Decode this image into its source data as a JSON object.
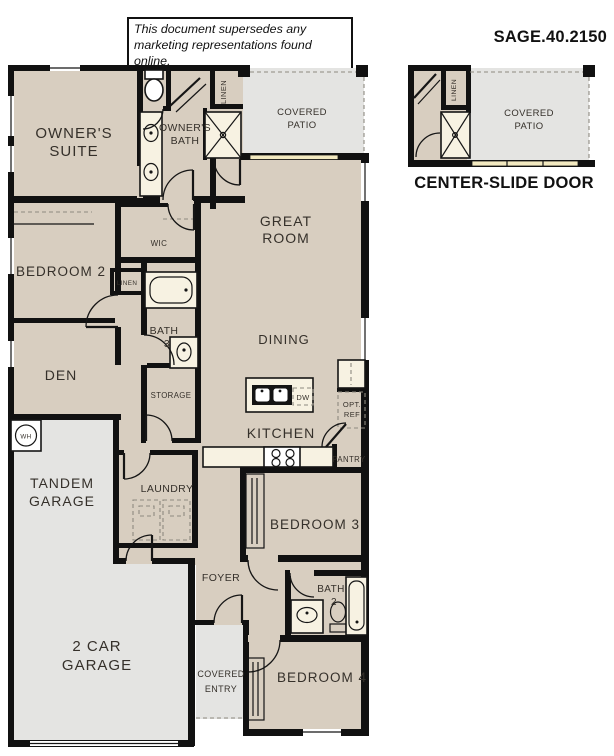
{
  "header": {
    "disclaimer": [
      "This document supersedes any",
      "marketing representations found online."
    ],
    "plan_code": "SAGE.40.2150"
  },
  "labels": {
    "owners_suite": [
      "OWNER'S",
      "SUITE"
    ],
    "owners_bath": [
      "OWNER'S",
      "BATH"
    ],
    "linen": "LINEN",
    "covered_patio": [
      "COVERED",
      "PATIO"
    ],
    "great_room": [
      "GREAT",
      "ROOM"
    ],
    "bedroom2": "BEDROOM 2",
    "wic": "WIC",
    "bath3": [
      "BATH",
      "3"
    ],
    "den": "DEN",
    "storage": "STORAGE",
    "dining": "DINING",
    "kitchen": "KITCHEN",
    "dw": "DW",
    "opt_ref": [
      "OPT.",
      "REF"
    ],
    "pantry": "PANTRY",
    "tandem_garage": [
      "TANDEM",
      "GARAGE"
    ],
    "laundry": "LAUNDRY",
    "wh": "WH",
    "bedroom3": "BEDROOM 3",
    "foyer": "FOYER",
    "bath2": [
      "BATH",
      "2"
    ],
    "two_car_garage": [
      "2 CAR",
      "GARAGE"
    ],
    "covered_entry": [
      "COVERED",
      "ENTRY"
    ],
    "bedroom4": "BEDROOM 4"
  },
  "inset": {
    "title": "CENTER-SLIDE DOOR",
    "covered_patio": [
      "COVERED",
      "PATIO"
    ],
    "linen": "LINEN"
  },
  "colors": {
    "floor": "#d8cec0",
    "outdoor": "#e4e4e2",
    "fixture": "#f7f2e2",
    "slide_door": "#f2e9c0",
    "wall": "#111111",
    "text": "#35302a",
    "dash": "#8e8a80"
  }
}
